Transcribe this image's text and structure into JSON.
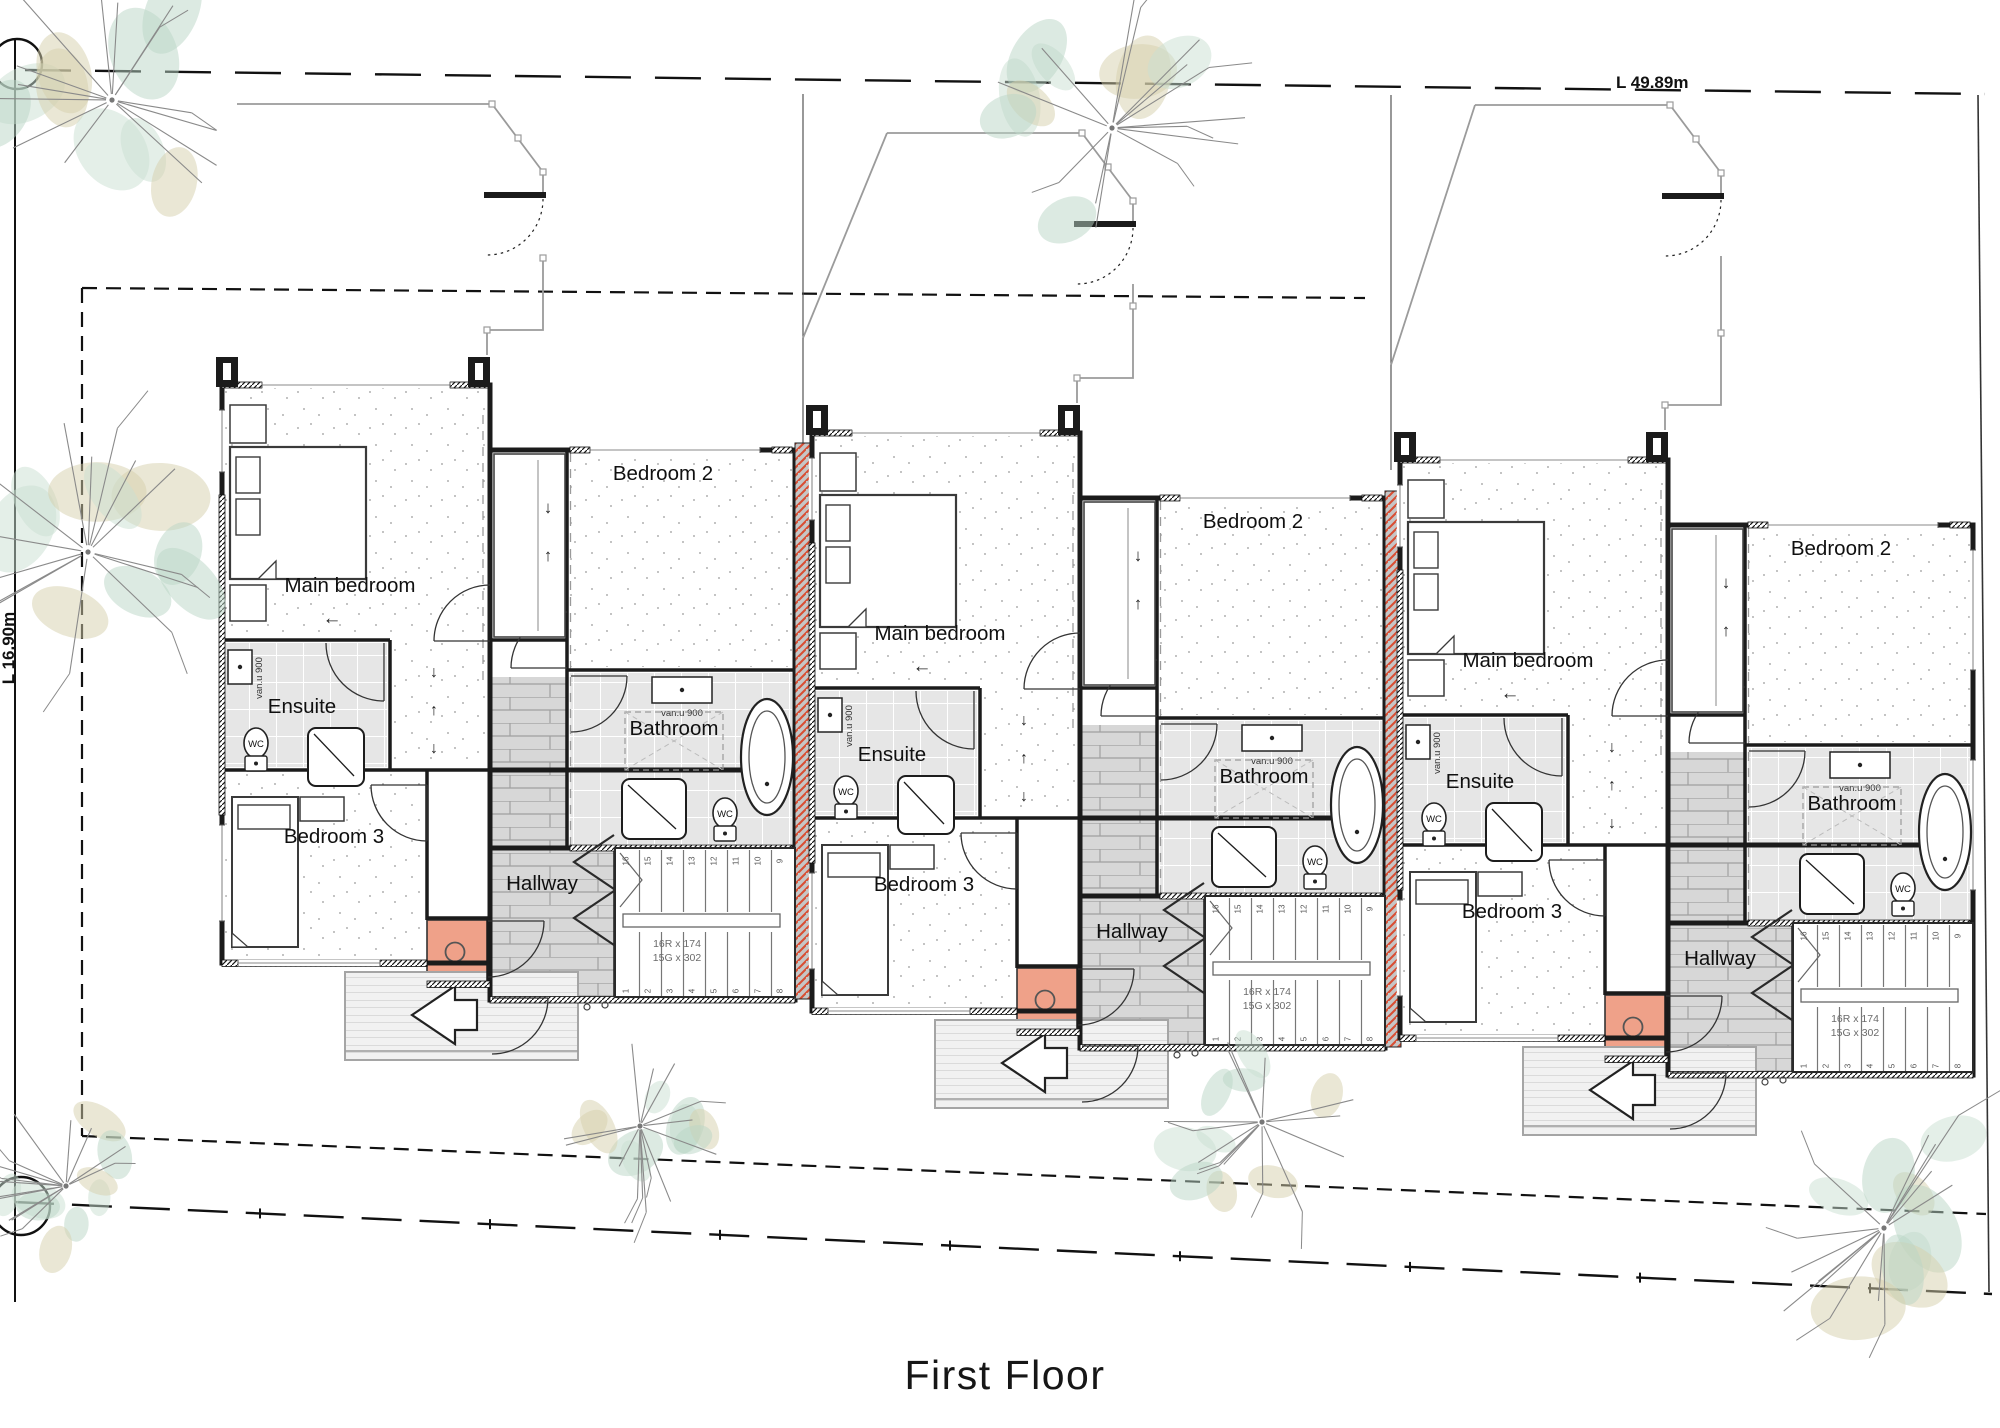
{
  "title": "First Floor",
  "boundary": {
    "top_dimension": "L 49.89m",
    "left_dimension": "L 16.90m"
  },
  "rooms": [
    {
      "key": "main-bedroom",
      "label": "Main bedroom"
    },
    {
      "key": "bedroom-2",
      "label": "Bedroom 2"
    },
    {
      "key": "ensuite",
      "label": "Ensuite"
    },
    {
      "key": "bathroom",
      "label": "Bathroom"
    },
    {
      "key": "bedroom-3",
      "label": "Bedroom 3"
    },
    {
      "key": "hallway",
      "label": "Hallway"
    }
  ],
  "fixtures": {
    "wc_label": "WC",
    "vanity_label": "van.u 900"
  },
  "stairs": {
    "note_line1": "16R x 174",
    "note_line2": "15G x 302",
    "upper_treads": [
      "16",
      "15",
      "14",
      "13",
      "12",
      "11",
      "10",
      "9"
    ],
    "lower_treads": [
      "1",
      "2",
      "3",
      "4",
      "5",
      "6",
      "7",
      "8"
    ]
  },
  "units": [
    {
      "id": "unit-1"
    },
    {
      "id": "unit-2"
    },
    {
      "id": "unit-3"
    }
  ],
  "arrows": {
    "down": "↓",
    "up": "↑",
    "left": "←"
  },
  "colors": {
    "wall": "#1b1b1b",
    "party_wall_bg": "#c6c6c6",
    "party_wall_stripe": "#d94e33",
    "tile": "#e6e6e6",
    "tile_grid": "#ffffff",
    "wood": "#d7d7d7",
    "wood_line": "#a0a0a0",
    "deck": "#f1f1f1",
    "deck_line": "#c4c4c4",
    "skylight": "#efa189",
    "stipple": "#8f8f8f",
    "outline_gray": "#9b9b9b",
    "tree_line": "#8a8a8a",
    "tree_green": "#c9dfd2",
    "tree_green2": "#b9d6c6",
    "tree_tan": "#d6d0ab",
    "text": "#101010",
    "stair_note": "#6b6b6b"
  }
}
